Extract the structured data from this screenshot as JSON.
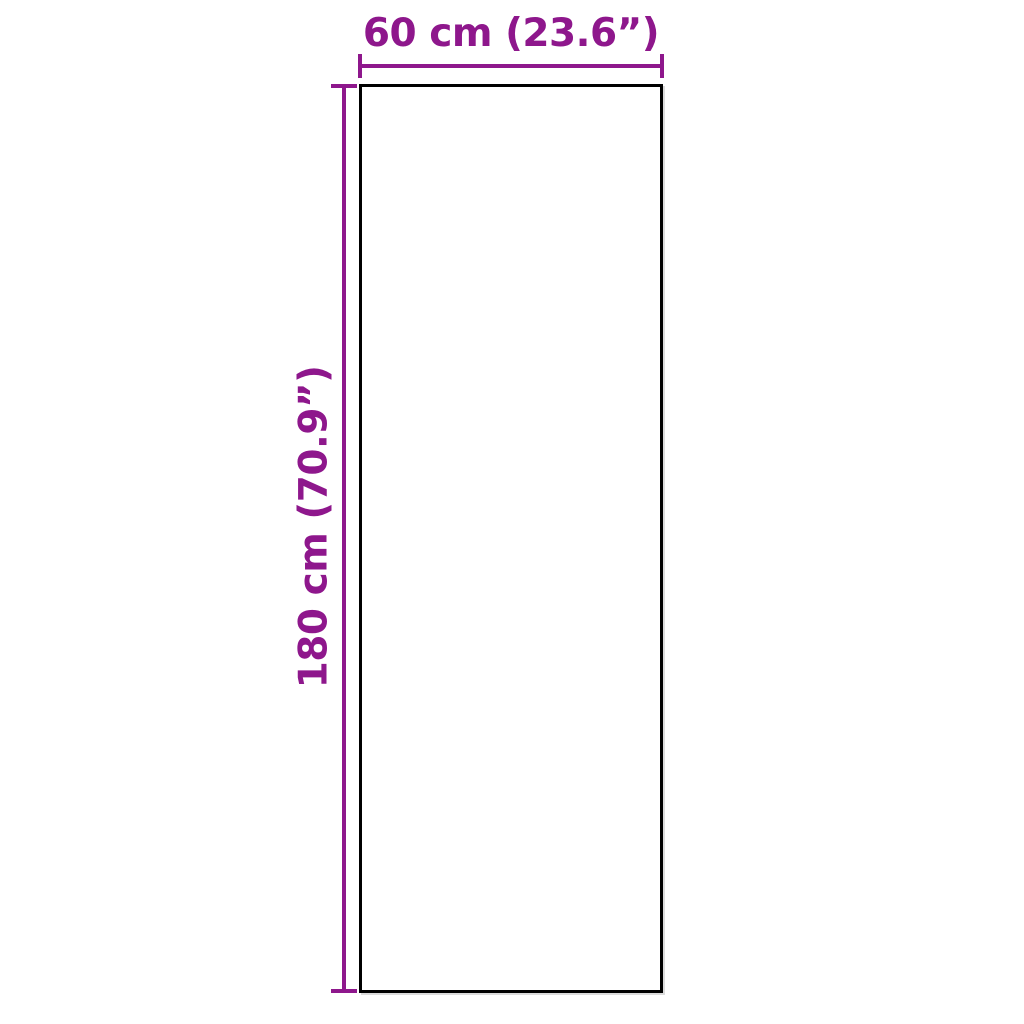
{
  "colors": {
    "dimension-color": "#8E178C",
    "outline-color": "#000000",
    "background-color": "#FFFFFF"
  },
  "diagram": {
    "kind": "product-dimension-diagram",
    "shape": "rectangle",
    "width": {
      "label": "60 cm (23.6”)",
      "cm": 60,
      "inches": 23.6
    },
    "height": {
      "label": "180 cm (70.9”)",
      "cm": 180,
      "inches": 70.9
    }
  }
}
